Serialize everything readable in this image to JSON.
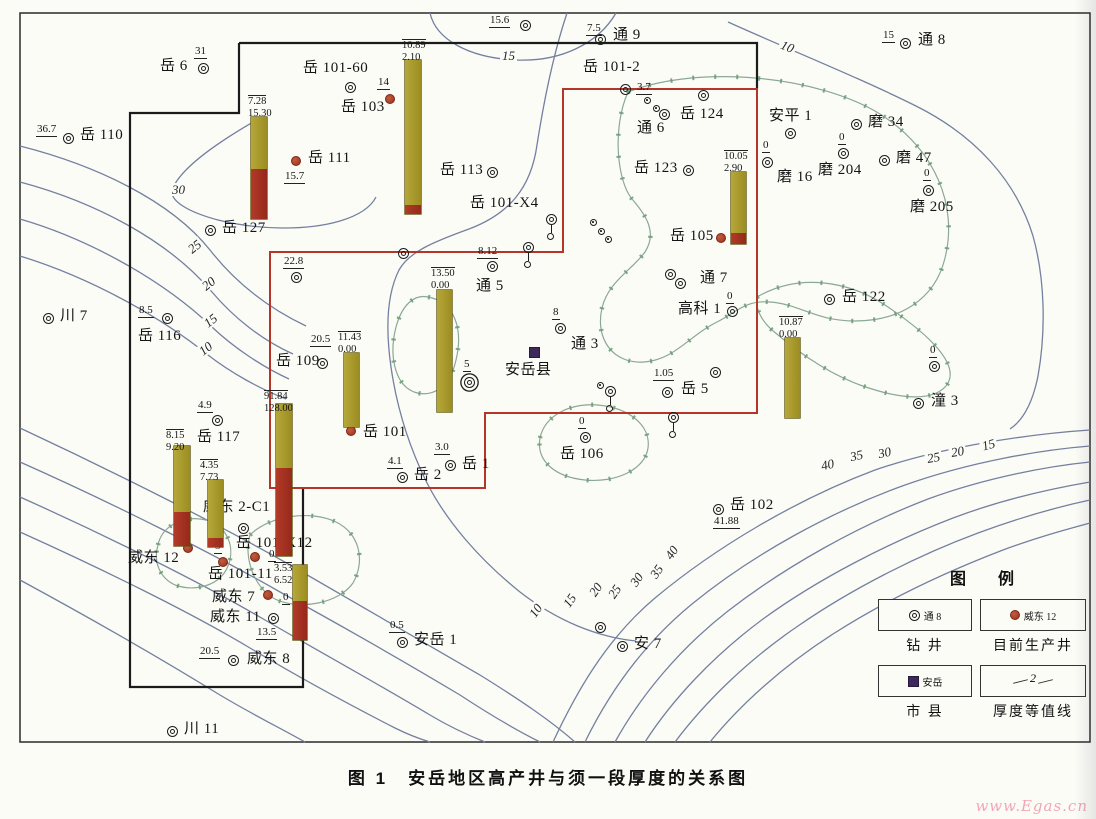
{
  "title": "图 1　安岳地区高产井与须一段厚度的关系图",
  "watermark": "www.Egas.cn",
  "colors": {
    "bar_olive": "#a89a2e",
    "bar_red": "#a93226",
    "producing_dot": "#b0452c",
    "boundary_red": "#b5352b",
    "boundary_black": "#1b1b1b",
    "contour_line": "#7480a0",
    "zero_line": "#8ca796",
    "city": "#3e2a5a",
    "watermark_pink": "#f2a6b5"
  },
  "legend": {
    "title": "图  例",
    "items": [
      {
        "symbol": "drilled-well",
        "example": "通 8",
        "label": "钻  井"
      },
      {
        "symbol": "producing-well",
        "example": "威东 12",
        "label": "目前生产井"
      },
      {
        "symbol": "city",
        "example": "安岳",
        "label": "市  县"
      },
      {
        "symbol": "thickness-contour",
        "example": "2",
        "label": "厚度等值线"
      }
    ]
  },
  "map": {
    "wells": [
      {
        "t": "w",
        "n": "岳 6",
        "x": 203,
        "y": 68,
        "nx": 160,
        "ny": 59,
        "v": "31",
        "vx": 194,
        "vy": 46
      },
      {
        "t": "w",
        "n": "岳 110",
        "x": 68,
        "y": 138,
        "nx": 80,
        "ny": 128,
        "v": "36.7",
        "vx": 36,
        "vy": 124
      },
      {
        "t": "w",
        "n": "岳 101-60",
        "x": 350,
        "y": 87,
        "nx": 303,
        "ny": 61
      },
      {
        "t": "p",
        "n": "岳 103",
        "x": 390,
        "y": 99,
        "nx": 341,
        "ny": 100,
        "v": "14",
        "vx": 377,
        "vy": 77
      },
      {
        "t": "p",
        "n": "岳 111",
        "x": 296,
        "y": 161,
        "nx": 308,
        "ny": 151,
        "v": "15.7",
        "vx": 284,
        "vy": 171
      },
      {
        "t": "w",
        "n": "",
        "x": 525,
        "y": 25,
        "v": "15.6",
        "vx": 489,
        "vy": 15
      },
      {
        "t": "w",
        "n": "通 9",
        "x": 600,
        "y": 39,
        "nx": 613,
        "ny": 28,
        "v": "7.5",
        "vx": 586,
        "vy": 23
      },
      {
        "t": "w",
        "n": "通 8",
        "x": 905,
        "y": 43,
        "nx": 918,
        "ny": 33,
        "v": "15",
        "vx": 882,
        "vy": 30
      },
      {
        "t": "w",
        "n": "岳 101-2",
        "x": 625,
        "y": 89,
        "nx": 583,
        "ny": 60,
        "v": "3.7",
        "vx": 636,
        "vy": 82
      },
      {
        "t": "s",
        "n": "",
        "x": 647,
        "y": 100
      },
      {
        "t": "s",
        "n": "",
        "x": 656,
        "y": 108
      },
      {
        "t": "w",
        "n": "通 6",
        "x": 664,
        "y": 114,
        "nx": 637,
        "ny": 121
      },
      {
        "t": "w",
        "n": "岳 124",
        "x": 703,
        "y": 95,
        "nx": 680,
        "ny": 107
      },
      {
        "t": "w",
        "n": "安平 1",
        "x": 790,
        "y": 133,
        "nx": 769,
        "ny": 109
      },
      {
        "t": "w",
        "n": "磨 34",
        "x": 856,
        "y": 124,
        "nx": 868,
        "ny": 115
      },
      {
        "t": "w",
        "n": "磨 204",
        "x": 843,
        "y": 153,
        "nx": 818,
        "ny": 163,
        "v": "0",
        "vx": 838,
        "vy": 132
      },
      {
        "t": "w",
        "n": "磨 47",
        "x": 884,
        "y": 160,
        "nx": 896,
        "ny": 151
      },
      {
        "t": "w",
        "n": "磨 205",
        "x": 928,
        "y": 190,
        "nx": 910,
        "ny": 200,
        "v": "0",
        "vx": 923,
        "vy": 168
      },
      {
        "t": "w",
        "n": "磨 16",
        "x": 767,
        "y": 162,
        "nx": 777,
        "ny": 170,
        "v": "0",
        "vx": 762,
        "vy": 140
      },
      {
        "t": "w",
        "n": "岳 123",
        "x": 688,
        "y": 170,
        "nx": 634,
        "ny": 161
      },
      {
        "t": "w",
        "n": "岳 113",
        "x": 492,
        "y": 172,
        "nx": 440,
        "ny": 163
      },
      {
        "t": "w",
        "n": "岳 127",
        "x": 210,
        "y": 230,
        "nx": 222,
        "ny": 221
      },
      {
        "t": "w",
        "n": "",
        "x": 296,
        "y": 277,
        "v": "22.8",
        "vx": 283,
        "vy": 256
      },
      {
        "t": "w",
        "n": "川 7",
        "x": 48,
        "y": 318,
        "nx": 60,
        "ny": 309
      },
      {
        "t": "w",
        "n": "岳 116",
        "x": 167,
        "y": 318,
        "nx": 138,
        "ny": 329,
        "v": "8.5",
        "vx": 138,
        "vy": 305
      },
      {
        "t": "w",
        "n": "岳 109",
        "x": 322,
        "y": 363,
        "nx": 276,
        "ny": 354,
        "v": "20.5",
        "vx": 310,
        "vy": 334
      },
      {
        "t": "w",
        "n": "通 5",
        "x": 492,
        "y": 266,
        "nx": 476,
        "ny": 279,
        "v": "8.12",
        "vx": 477,
        "vy": 246
      },
      {
        "t": "tl",
        "n": "",
        "x": 528,
        "y": 247
      },
      {
        "t": "tl",
        "n": "岳 101-X4",
        "x": 551,
        "y": 219,
        "nx": 470,
        "ny": 196
      },
      {
        "t": "s",
        "n": "",
        "x": 593,
        "y": 222
      },
      {
        "t": "s",
        "n": "",
        "x": 601,
        "y": 231
      },
      {
        "t": "s",
        "n": "",
        "x": 608,
        "y": 239
      },
      {
        "t": "w",
        "n": "通 3",
        "x": 560,
        "y": 328,
        "nx": 571,
        "ny": 337,
        "v": "8",
        "vx": 552,
        "vy": 307
      },
      {
        "t": "c",
        "n": "安岳县",
        "x": 534,
        "y": 352,
        "nx": 505,
        "ny": 363
      },
      {
        "t": "t3",
        "n": "",
        "x": 469,
        "y": 382,
        "v": "5",
        "vx": 463,
        "vy": 359
      },
      {
        "t": "w",
        "n": "",
        "x": 670,
        "y": 274
      },
      {
        "t": "w",
        "n": "通 7",
        "x": 680,
        "y": 283,
        "nx": 700,
        "ny": 271
      },
      {
        "t": "w",
        "n": "高科 1",
        "x": 732,
        "y": 311,
        "nx": 678,
        "ny": 302,
        "v": "0",
        "vx": 726,
        "vy": 291
      },
      {
        "t": "w",
        "n": "岳 122",
        "x": 829,
        "y": 299,
        "nx": 842,
        "ny": 290
      },
      {
        "t": "p",
        "n": "岳 105",
        "x": 721,
        "y": 238,
        "nx": 670,
        "ny": 229
      },
      {
        "t": "w",
        "n": "岳 5",
        "x": 667,
        "y": 392,
        "nx": 681,
        "ny": 382,
        "v": "1.05",
        "vx": 653,
        "vy": 368
      },
      {
        "t": "w",
        "n": "",
        "x": 715,
        "y": 372
      },
      {
        "t": "s",
        "n": "",
        "x": 600,
        "y": 385
      },
      {
        "t": "tl",
        "n": "",
        "x": 610,
        "y": 391
      },
      {
        "t": "tl",
        "n": "",
        "x": 673,
        "y": 417
      },
      {
        "t": "w",
        "n": "潼 3",
        "x": 918,
        "y": 403,
        "nx": 931,
        "ny": 394
      },
      {
        "t": "w",
        "n": "",
        "x": 934,
        "y": 366,
        "v": "0",
        "vx": 929,
        "vy": 345
      },
      {
        "t": "w",
        "n": "岳 106",
        "x": 585,
        "y": 437,
        "nx": 560,
        "ny": 447,
        "v": "0",
        "vx": 578,
        "vy": 416
      },
      {
        "t": "w",
        "n": "岳 2",
        "x": 402,
        "y": 477,
        "nx": 414,
        "ny": 468,
        "v": "4.1",
        "vx": 387,
        "vy": 456
      },
      {
        "t": "w",
        "n": "岳 1",
        "x": 450,
        "y": 465,
        "nx": 462,
        "ny": 457,
        "v": "3.0",
        "vx": 434,
        "vy": 442
      },
      {
        "t": "w",
        "n": "岳 102",
        "x": 718,
        "y": 509,
        "nx": 730,
        "ny": 498,
        "v": "41.88",
        "vx": 713,
        "vy": 516
      },
      {
        "t": "w",
        "n": "岳 117",
        "x": 217,
        "y": 420,
        "nx": 197,
        "ny": 430,
        "v": "4.9",
        "vx": 197,
        "vy": 400
      },
      {
        "t": "w",
        "n": "威东 2-C1",
        "x": 243,
        "y": 528,
        "nx": 203,
        "ny": 500,
        "v": "5",
        "vx": 214,
        "vy": 541
      },
      {
        "t": "p",
        "n": "岳 101-X12",
        "x": 255,
        "y": 557,
        "nx": 236,
        "ny": 536,
        "v": "0",
        "vx": 268,
        "vy": 549
      },
      {
        "t": "p",
        "n": "岳 101-11",
        "x": 223,
        "y": 562,
        "nx": 208,
        "ny": 567
      },
      {
        "t": "p",
        "n": "威东 12",
        "x": 188,
        "y": 548,
        "nx": 128,
        "ny": 551
      },
      {
        "t": "p",
        "n": "威东 7",
        "x": 268,
        "y": 595,
        "nx": 212,
        "ny": 590,
        "v": "0",
        "vx": 282,
        "vy": 592
      },
      {
        "t": "w",
        "n": "威东 11",
        "x": 273,
        "y": 618,
        "nx": 210,
        "ny": 610,
        "v": "13.5",
        "vx": 256,
        "vy": 627
      },
      {
        "t": "w",
        "n": "威东 8",
        "x": 233,
        "y": 660,
        "nx": 247,
        "ny": 652,
        "v": "20.5",
        "vx": 199,
        "vy": 646
      },
      {
        "t": "w",
        "n": "川 11",
        "x": 172,
        "y": 731,
        "nx": 184,
        "ny": 722
      },
      {
        "t": "w",
        "n": "安岳 1",
        "x": 402,
        "y": 642,
        "nx": 414,
        "ny": 633,
        "v": "0.5",
        "vx": 389,
        "vy": 620
      },
      {
        "t": "w",
        "n": "安 7",
        "x": 622,
        "y": 646,
        "nx": 634,
        "ny": 637
      },
      {
        "t": "w",
        "n": "",
        "x": 600,
        "y": 627
      },
      {
        "t": "w",
        "n": "",
        "x": 403,
        "y": 253
      },
      {
        "t": "p",
        "n": "岳 101",
        "x": 351,
        "y": 431,
        "nx": 363,
        "ny": 425
      }
    ],
    "bars": [
      {
        "x": 251,
        "y": 117,
        "w": 16,
        "o": 52,
        "r": 50,
        "v1": "7.28",
        "v2": "15.30",
        "lx": 248,
        "ly": 95
      },
      {
        "x": 405,
        "y": 60,
        "w": 16,
        "o": 145,
        "r": 9,
        "v1": "10.89",
        "v2": "2.10",
        "lx": 402,
        "ly": 39
      },
      {
        "x": 731,
        "y": 172,
        "w": 15,
        "o": 61,
        "r": 11,
        "v1": "10.05",
        "v2": "2.90",
        "lx": 724,
        "ly": 150
      },
      {
        "x": 437,
        "y": 290,
        "w": 15,
        "o": 122,
        "r": 0,
        "v1": "13.50",
        "v2": "0.00",
        "lx": 431,
        "ly": 267
      },
      {
        "x": 344,
        "y": 353,
        "w": 15,
        "o": 74,
        "r": 0,
        "v1": "11.43",
        "v2": "0.00",
        "lx": 338,
        "ly": 331
      },
      {
        "x": 276,
        "y": 404,
        "w": 16,
        "o": 64,
        "r": 88,
        "v1": "91.84",
        "v2": "128.00",
        "lx": 264,
        "ly": 390
      },
      {
        "x": 174,
        "y": 446,
        "w": 16,
        "o": 66,
        "r": 34,
        "v1": "8.15",
        "v2": "9.20",
        "lx": 166,
        "ly": 429
      },
      {
        "x": 208,
        "y": 480,
        "w": 15,
        "o": 58,
        "r": 9,
        "v1": "4.35",
        "v2": "7.73",
        "lx": 200,
        "ly": 459
      },
      {
        "x": 293,
        "y": 565,
        "w": 14,
        "o": 36,
        "r": 39,
        "v1": "3.53",
        "v2": "6.52",
        "lx": 274,
        "ly": 562
      },
      {
        "x": 785,
        "y": 338,
        "w": 15,
        "o": 80,
        "r": 0,
        "v1": "10.87",
        "v2": "0.00",
        "lx": 779,
        "ly": 316
      }
    ],
    "contour_labels": [
      {
        "t": "30",
        "x": 170,
        "y": 183,
        "r": 0
      },
      {
        "t": "25",
        "x": 186,
        "y": 240,
        "r": -38
      },
      {
        "t": "20",
        "x": 200,
        "y": 277,
        "r": -38
      },
      {
        "t": "15",
        "x": 202,
        "y": 314,
        "r": -38
      },
      {
        "t": "10",
        "x": 197,
        "y": 342,
        "r": -38
      },
      {
        "t": "15",
        "x": 500,
        "y": 49,
        "r": 0
      },
      {
        "t": "10",
        "x": 779,
        "y": 40,
        "r": 22
      },
      {
        "t": "10",
        "x": 527,
        "y": 604,
        "r": -55
      },
      {
        "t": "15",
        "x": 561,
        "y": 594,
        "r": -55
      },
      {
        "t": "20",
        "x": 587,
        "y": 583,
        "r": -55
      },
      {
        "t": "25",
        "x": 606,
        "y": 585,
        "r": -55
      },
      {
        "t": "30",
        "x": 628,
        "y": 573,
        "r": -55
      },
      {
        "t": "35",
        "x": 648,
        "y": 565,
        "r": -55
      },
      {
        "t": "40",
        "x": 663,
        "y": 546,
        "r": -55
      },
      {
        "t": "40",
        "x": 819,
        "y": 458,
        "r": -12
      },
      {
        "t": "35",
        "x": 848,
        "y": 449,
        "r": -12
      },
      {
        "t": "30",
        "x": 876,
        "y": 446,
        "r": -12
      },
      {
        "t": "25",
        "x": 925,
        "y": 451,
        "r": -10
      },
      {
        "t": "20",
        "x": 949,
        "y": 445,
        "r": -10
      },
      {
        "t": "15",
        "x": 980,
        "y": 438,
        "r": -15
      }
    ]
  }
}
